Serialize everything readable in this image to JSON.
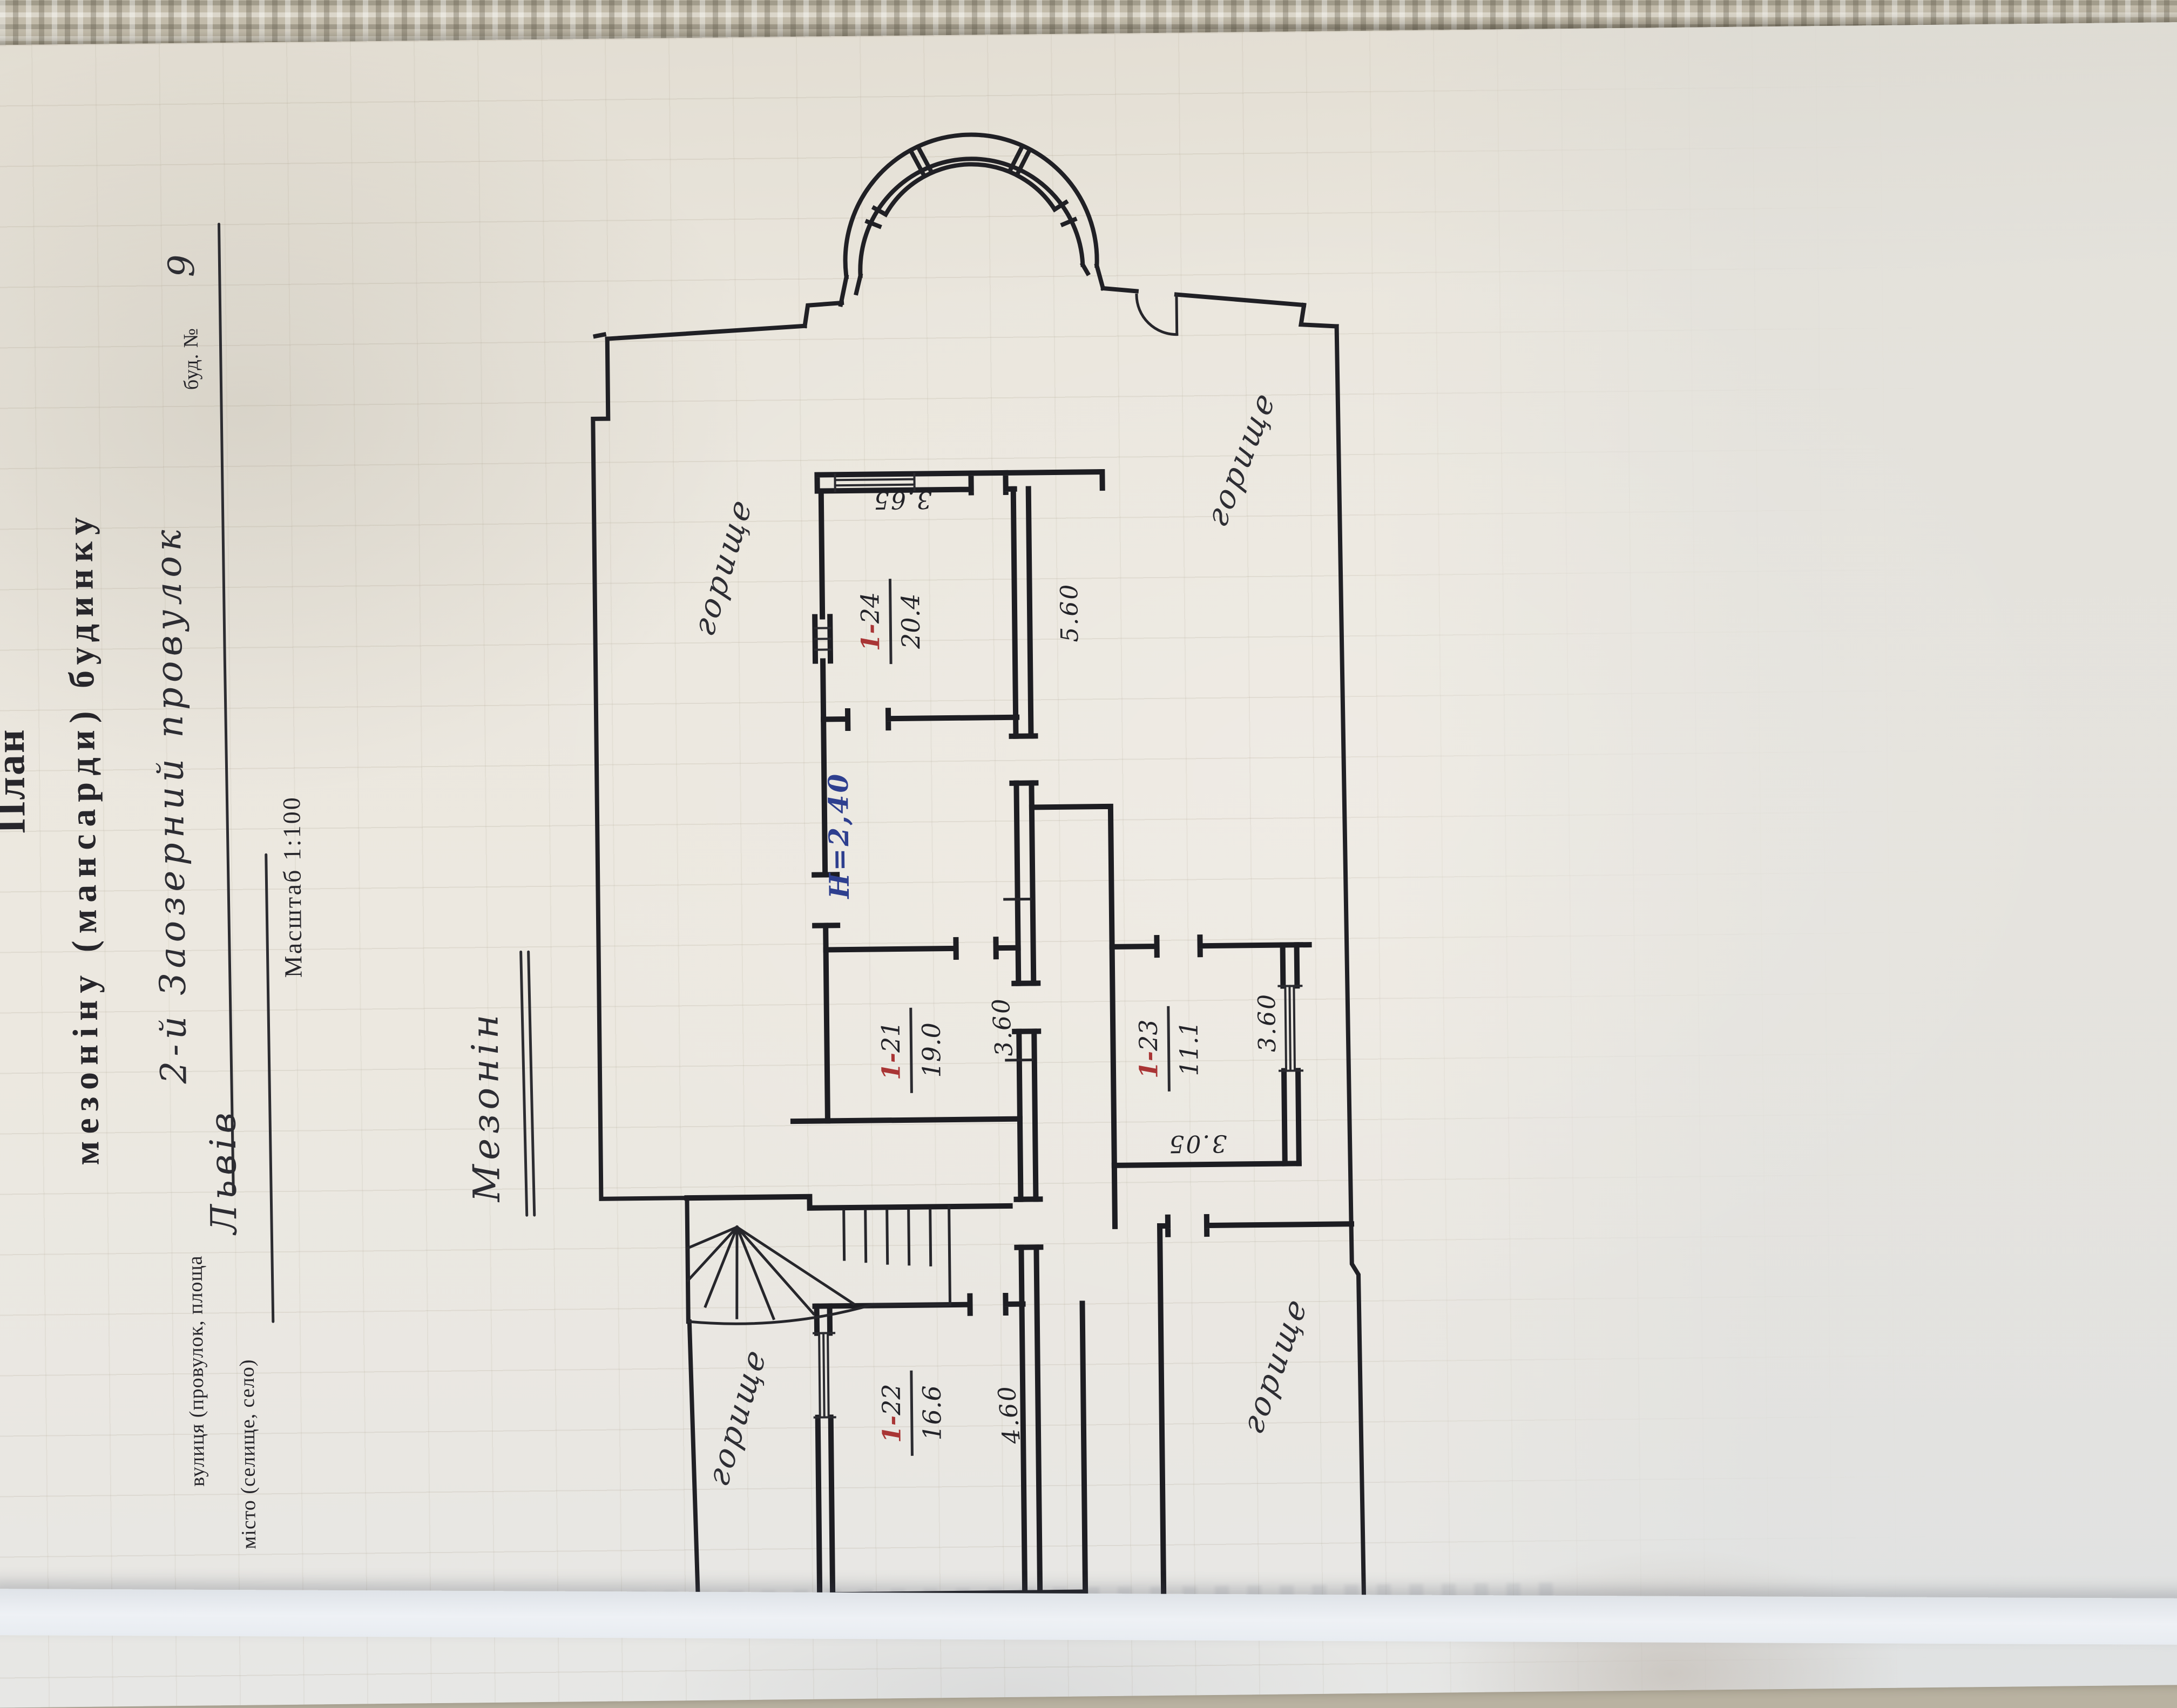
{
  "document": {
    "title": {
      "line1": "План",
      "line2": "мезоніну (мансарди) будинку"
    },
    "address_form": {
      "street_label": "вулиця (провулок, площа",
      "street_value": "2-й Заозерний провулок",
      "house_label": "буд. №",
      "house_value": "9",
      "city_label": "місто (селище, село)",
      "city_value": "Львів"
    },
    "scale_note": "Масштаб 1:100",
    "plan_title": "Мезонін",
    "height_note": "Н=2,40",
    "attic_labels": {
      "top_left": "горище",
      "right": "горище",
      "bottom_left": "горище",
      "bottom_right": "горище"
    },
    "rooms": [
      {
        "number_prefix": "1-",
        "number": "21",
        "area": "19.0"
      },
      {
        "number_prefix": "1-",
        "number": "22",
        "area": "16.6"
      },
      {
        "number_prefix": "1-",
        "number": "23",
        "area": "11.1"
      },
      {
        "number_prefix": "1-",
        "number": "24",
        "area": "20.4"
      }
    ],
    "dimensions": {
      "room24_width": "3.65",
      "room24_depth": "5.60",
      "room21_width": "3.60",
      "room23_width": "3.05",
      "room23_depth": "3.60",
      "room22_depth": "4.60",
      "room22_width": "3.60"
    },
    "colors": {
      "paper": "#eae6dd",
      "ink": "#202025",
      "red_ink": "#a93535",
      "blue_ink": "#2e3f8f",
      "fabric": "#c2bbaa"
    }
  }
}
